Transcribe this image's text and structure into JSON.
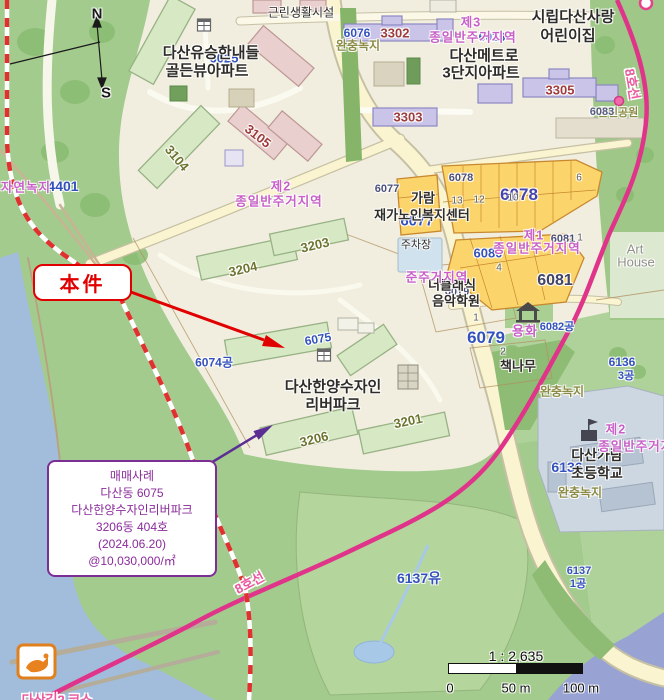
{
  "annotations": {
    "subject": {
      "label": "本件"
    },
    "sale": {
      "line1": "매매사례",
      "line2": "다산동 6075",
      "line3": "다산한양수자인리버파크",
      "line4": "3206동 404호",
      "line5": "(2024.06.20)",
      "line6": "@10,030,000/㎡"
    }
  },
  "compass": {
    "north": "N",
    "south": "S"
  },
  "scalebar": {
    "ratio": "1 : 2,635",
    "start": "0",
    "mid": "50 m",
    "end": "100 m"
  },
  "colors": {
    "subject_red": "#e10000",
    "annotation_purple": "#8a2b9b",
    "rail_line_pink": "#df3489",
    "parcel_blue": "#3351bd",
    "zone_magenta": "#c75fc7",
    "park_green": "#a3cb8d",
    "water_blue": "#a2bcdb",
    "parcel_yellow": "#fbd56b"
  },
  "labels": {
    "neighborhood_facility": "근린생활시설",
    "apt1_line1": "다산유승한내들",
    "apt1_line2": "골든뷰아파트",
    "apt1_parcel": "6025",
    "metro_line1": "다산메트로",
    "metro_line2": "3단지아파트",
    "daycare_line1": "시립다산사랑",
    "daycare_line2": "어린이집",
    "b3302": "3302",
    "b3303": "3303",
    "b3305": "3305",
    "b3104": "3104",
    "b3105": "3105",
    "b3204": "3204",
    "b3203": "3203",
    "b3206": "3206",
    "b3201": "3201",
    "zone3_prefix": "제3",
    "zone3_body": "종일반주거지역",
    "zone3_parcel": "6026",
    "buffer_top": "완충녹지",
    "buffer_top_parcel": "6076",
    "line8_top": "8호선",
    "line8_bottom": "8호선",
    "park_6083": "6083",
    "park_6083_name": "근린공원",
    "zone2_prefix": "제2",
    "zone2_body": "종일반주거지역",
    "nature_green": "자연녹지",
    "nature_green_parcel": "4401",
    "p6077_small": "6077",
    "p6077": "6077",
    "center_line1": "가람",
    "center_line2": "재가노인복지센터",
    "parking": "주차장",
    "p6078_small": "6078",
    "p6078": "6078",
    "n13": "13",
    "n12": "12",
    "n10": "10",
    "n6": "6",
    "n4": "4",
    "n1a": "1",
    "n1b": "1",
    "n2": "2",
    "zone1_prefix": "제1",
    "zone1_body": "종일반주거지역",
    "p6080": "6080",
    "p6081_small": "6081",
    "p6081": "6081",
    "art_line1": "Art",
    "art_line2": "House",
    "semi_res_zone": "준주거지역",
    "academy_line1": "더클래식",
    "academy_line2": "음악학원",
    "p6079_small": "6079",
    "p6079": "6079",
    "yonghwa": "용화",
    "p6082": "6082공",
    "tree_label": "책나무",
    "p6074": "6074공",
    "p6075": "6075",
    "apt2_line1": "다산한양수자인",
    "apt2_line2": "리버파크",
    "buffer_right": "완충녹지",
    "p6136_right_line1": "6136",
    "p6136_right_line2": "3공",
    "zone2b_prefix": "제2",
    "zone2b_body": "종일반주거지역",
    "school_line1": "다산가람",
    "school_line2": "초등학교",
    "school_parcel": "6136",
    "buffer_bottom": "완충녹지",
    "p6137yu": "6137유",
    "p6137": "6137",
    "p6137_suffix": "1공",
    "course_label": "다산길2 코스"
  }
}
